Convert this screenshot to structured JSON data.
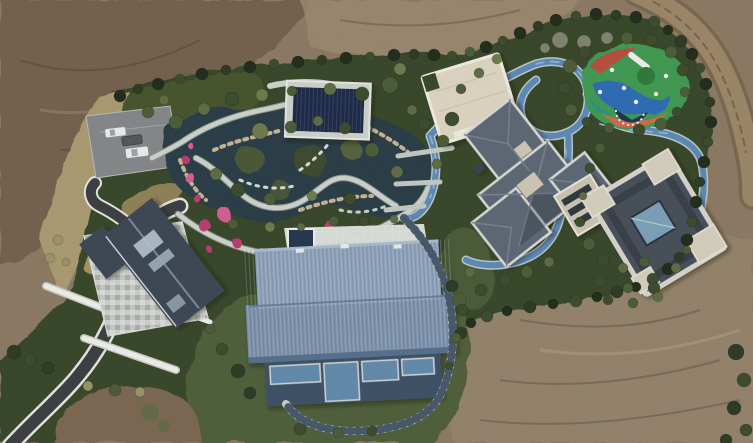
{
  "meta": {
    "type": "aerial-drone-photograph",
    "subject": "Top-down aerial view of a landscaped private estate with ponds, winding paths and several houses, surrounded by bare graded earth",
    "width_px": 753,
    "height_px": 443
  },
  "palette": {
    "dirt": "#8c7a64",
    "dirtDark": "#6f5d4a",
    "dirtLight": "#9e8b73",
    "dirtBottom": "#7b6852",
    "roadDirt": "#9c8768",
    "roadDirtEdge": "#7a6850",
    "dryGrass": "#ab9b72",
    "lawn": "#4f5e3a",
    "green": "#37462c",
    "gardenGreen": "#49562f",
    "water": "#2c3d46",
    "gardenPath": "#cdd3cd",
    "pathCasing": "#8e968e",
    "trackBlue": "#5d8ab5",
    "trackEdge": "#b9c6ce",
    "stepPath": "#c9d0cb",
    "stepRung": "#47586a",
    "asphalt": "#3c3f42",
    "roadLine": "#e6e6e2",
    "parking": "#85888a",
    "carWhite": "#eceeef",
    "carDark": "#53575c",
    "leftRoof": "#3d4654",
    "terraceStone": "#c6cac5",
    "whiteBar": "#eef0ec",
    "pavilionNavy": "#1e2c49",
    "pavilionFrame": "#ccd2cc",
    "cream": "#ded6c3",
    "creamEdge": "#f0ede3",
    "midRoof": "#5d6774",
    "midRoofLight": "#79828f",
    "roofEdge": "#dadbd7",
    "rightRoof": "#474f5a",
    "glass": "#7ca1b8",
    "barnRoof": "#7e93ad",
    "barnRoofLight": "#8fa3bc",
    "barnRoofDark": "#55708e",
    "barnWall": "#3e5166",
    "barnGlass": "#628bab",
    "terraceWhite": "#d9ded8",
    "spaNavy": "#233850",
    "pgGreen": "#3f9a52",
    "pgBlue": "#2f6cb5",
    "pgOrange": "#d4694b",
    "pgRed": "#bf4a3e",
    "pgTeal": "#2e8f8a",
    "pgNavy": "#1f3550",
    "flower": "#bb3c70",
    "flowerLight": "#d55e93",
    "rock": "#c6b592"
  },
  "features": {
    "vehicles_in_car_park": 3,
    "buildings": [
      "left-gabled-house-with-stone-terrace",
      "navy-pool-pavilion",
      "cream-flat-roof-hall",
      "central-gray-hip-roof-house",
      "east-courtyard-house",
      "large-blue-metal-roof-barn-house"
    ],
    "landscape": [
      "rock-edged-koi-pond-garden",
      "pink-azalea-beds",
      "winding-blue-stream-track",
      "stepped-stone-path-around-barn",
      "colorful-playground",
      "perimeter-hedge-and-trees",
      "dirt-road-top-right",
      "asphalt-driveway-bottom-left",
      "bare-earth-surroundings"
    ]
  }
}
